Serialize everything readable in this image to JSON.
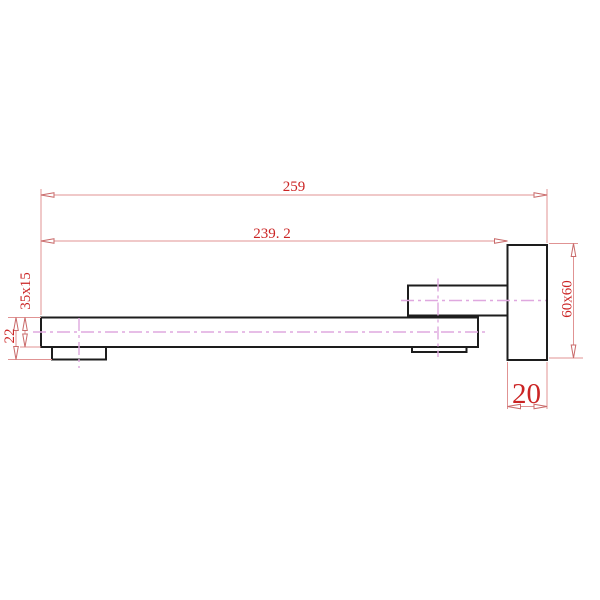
{
  "drawing": {
    "kind": "CAD technical drawing - wall-mounted square bath spout, side elevation",
    "background_color": "#ffffff",
    "outline_color": "#1d1d1d",
    "dimension_line_color": "#e09393",
    "dimension_text_color": "#cb2424",
    "centerline_color": "#dfa8df",
    "dimensions": {
      "overall_length": {
        "label": "259"
      },
      "spout_projection": {
        "label": "239. 2"
      },
      "spout_section": {
        "label": "35x15"
      },
      "outlet_depth": {
        "label": "22"
      },
      "wall_plate_face": {
        "label": "60x60"
      },
      "wall_plate_thickness": {
        "label": "20"
      }
    }
  }
}
